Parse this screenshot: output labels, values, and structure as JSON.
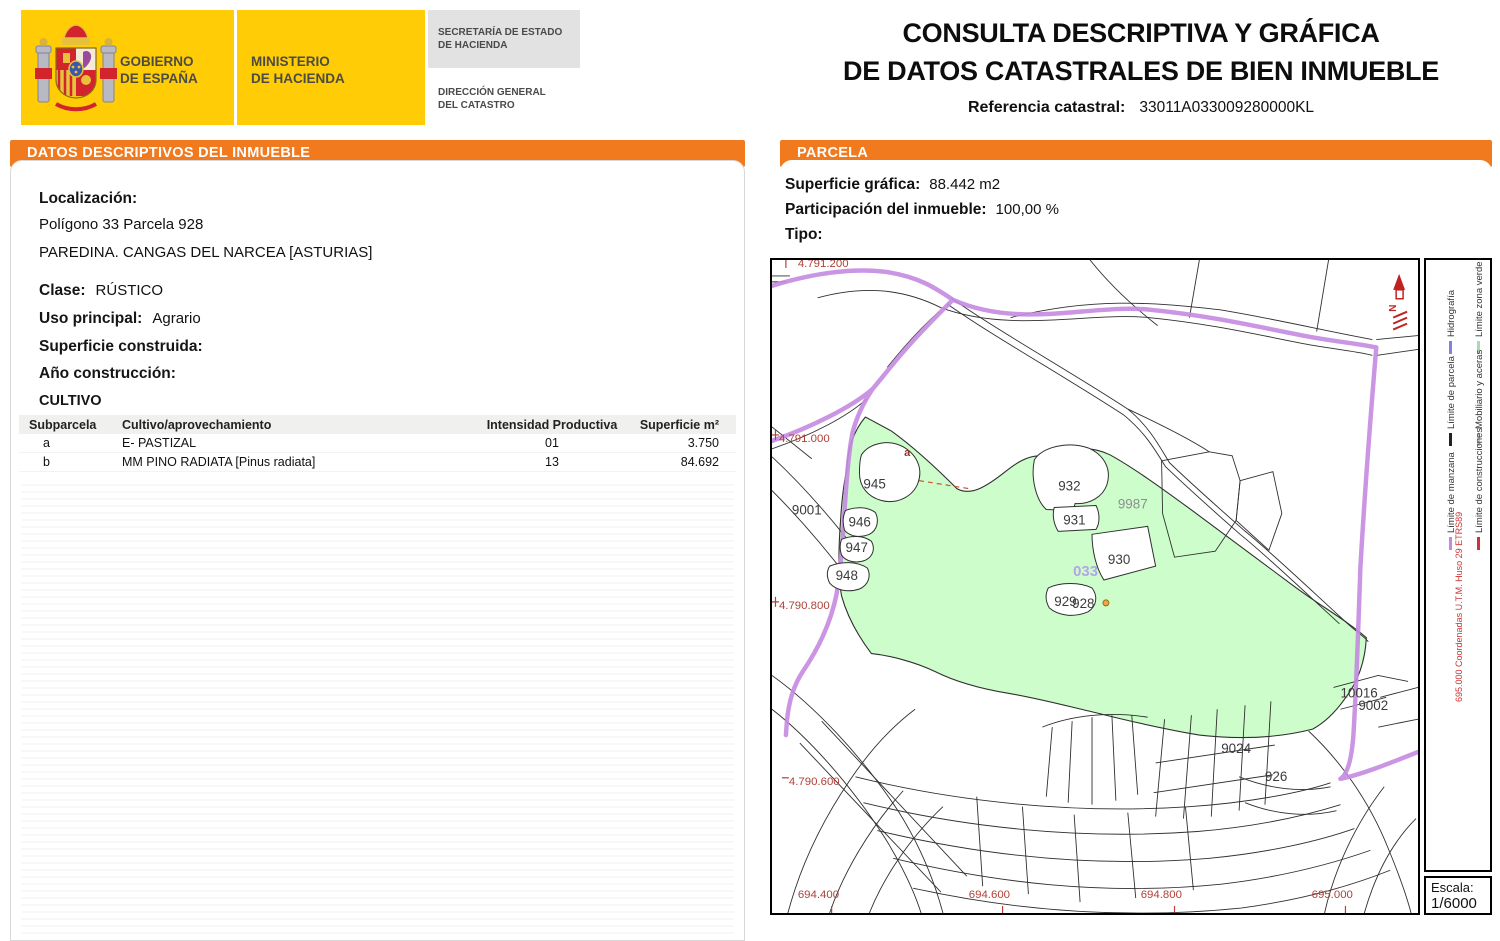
{
  "colors": {
    "accent_orange": "#F07A1D",
    "header_yellow": "#FFCC05",
    "map_green_fill": "#CCFDCB",
    "map_purple_road": "#C58AE0",
    "map_coordinate_red": "#B04038",
    "legend_red": "#CC3333"
  },
  "header": {
    "logo": {
      "gobierno_line1": "GOBIERNO",
      "gobierno_line2": "DE ESPAÑA",
      "ministerio_line1": "MINISTERIO",
      "ministerio_line2": "DE HACIENDA",
      "secretaria_line1": "SECRETARÍA DE ESTADO",
      "secretaria_line2": "DE HACIENDA",
      "direccion_line1": "DIRECCIÓN GENERAL",
      "direccion_line2": "DEL CATASTRO"
    },
    "title_line1": "CONSULTA DESCRIPTIVA Y GRÁFICA",
    "title_line2": "DE DATOS CATASTRALES DE BIEN INMUEBLE",
    "ref_label": "Referencia catastral:",
    "ref_value": "33011A033009280000KL"
  },
  "left_panel": {
    "header": "DATOS DESCRIPTIVOS DEL INMUEBLE",
    "localizacion_label": "Localización:",
    "localizacion_line1": "Polígono 33 Parcela 928",
    "localizacion_line2": "PAREDINA. CANGAS DEL NARCEA [ASTURIAS]",
    "clase_label": "Clase:",
    "clase_value": "RÚSTICO",
    "uso_label": "Uso principal:",
    "uso_value": "Agrario",
    "superficie_construida_label": "Superficie construida:",
    "superficie_construida_value": "",
    "anio_construccion_label": "Año construcción:",
    "anio_construccion_value": "",
    "cultivo_title": "CULTIVO",
    "cultivo_table": {
      "headers": [
        "Subparcela",
        "Cultivo/aprovechamiento",
        "Intensidad Productiva",
        "Superficie m²"
      ],
      "rows": [
        {
          "subparcela": "a",
          "cultivo": "E- PASTIZAL",
          "intensidad": "01",
          "superficie": "3.750"
        },
        {
          "subparcela": "b",
          "cultivo": "MM PINO RADIATA [Pinus radiata]",
          "intensidad": "13",
          "superficie": "84.692"
        }
      ]
    }
  },
  "right_panel": {
    "header": "PARCELA",
    "superficie_grafica_label": "Superficie gráfica:",
    "superficie_grafica_value": "88.442 m2",
    "participacion_label": "Participación del inmueble:",
    "participacion_value": "100,00 %",
    "tipo_label": "Tipo:",
    "tipo_value": ""
  },
  "map": {
    "north_label": "N",
    "parcel_labels": {
      "p9001": "9001",
      "p945": "945",
      "p946": "946",
      "p947": "947",
      "p948": "948",
      "p932": "932",
      "p931": "931",
      "p930": "930",
      "p929": "929",
      "p928": "928",
      "p9987": "9987",
      "p033": "033",
      "p10016": "10016",
      "p9002": "9002",
      "p9024": "9024",
      "p926": "926",
      "subparcela_a": "a"
    },
    "coordinate_labels": {
      "top": "4.791.200",
      "left_upper": "4.791.000",
      "left_middle": "4.790.800",
      "left_lower": "4.790.600",
      "bottom_1": "694.400",
      "bottom_2": "694.600",
      "bottom_3": "694.800",
      "bottom_4": "695.000"
    },
    "legend": {
      "items": [
        {
          "label": "Hidrografía",
          "color": "#8282DD"
        },
        {
          "label": "Límite zona verde",
          "color": "#A9DCA9"
        },
        {
          "label": "Límite de parcela",
          "color": "#222222"
        },
        {
          "label": "Mobiliario y aceras",
          "color": "#C8C8C8"
        },
        {
          "label": "Límite de manzana",
          "color": "#C58AE0"
        },
        {
          "label": "Límite de construcciones",
          "color": "#CC3333"
        }
      ],
      "utm_note": "695.000 Coordenadas U.T.M. Huso 29 ETRS89",
      "escala_label": "Escala:",
      "escala_value": "1/6000"
    }
  }
}
